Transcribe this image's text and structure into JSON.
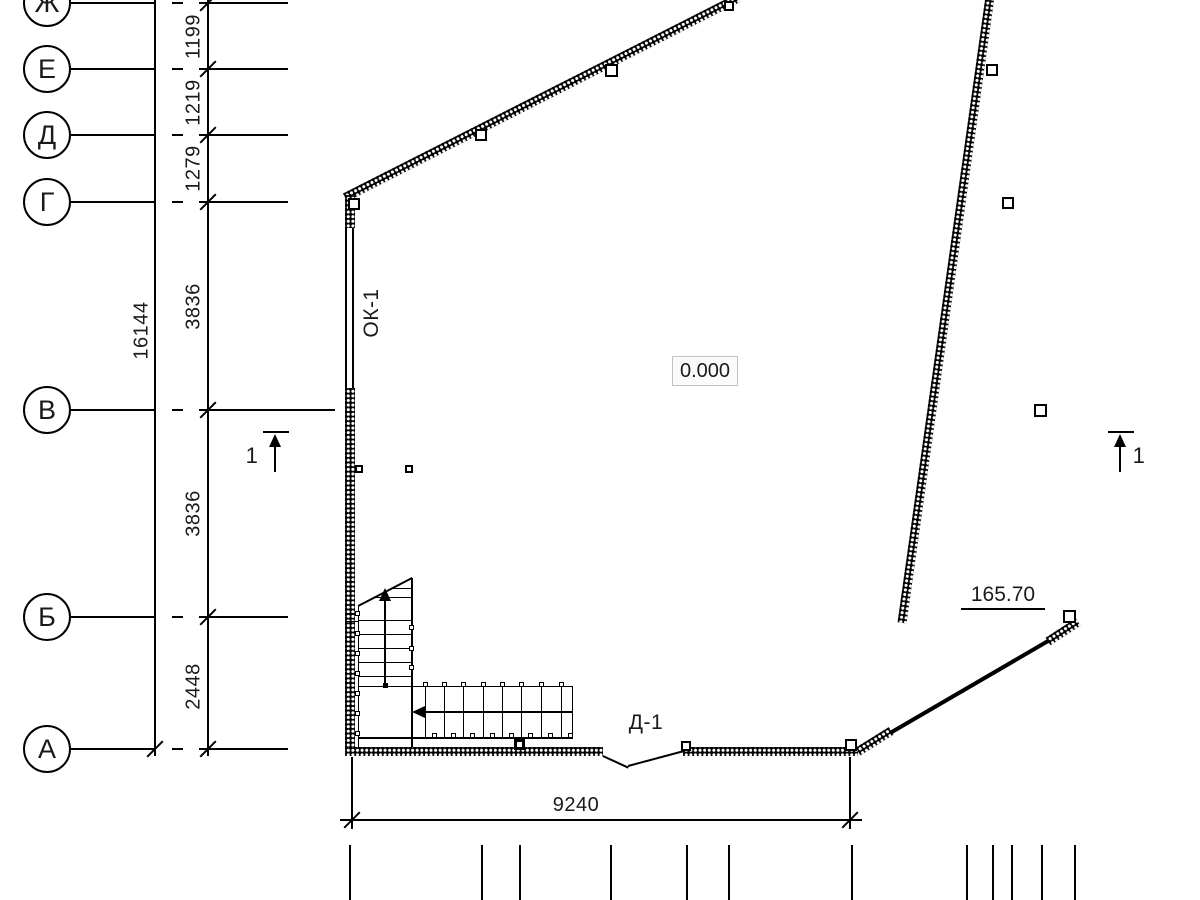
{
  "axes": {
    "rows": [
      {
        "label": "Ж",
        "y": 3
      },
      {
        "label": "Е",
        "y": 69
      },
      {
        "label": "Д",
        "y": 135
      },
      {
        "label": "Г",
        "y": 202
      },
      {
        "label": "В",
        "y": 410
      },
      {
        "label": "Б",
        "y": 617
      },
      {
        "label": "А",
        "y": 749
      }
    ]
  },
  "dimensions": {
    "left_chain": [
      {
        "value": "1199",
        "y": 36
      },
      {
        "value": "1219",
        "y": 102
      },
      {
        "value": "1279",
        "y": 168
      },
      {
        "value": "3836",
        "y": 306
      },
      {
        "value": "3836",
        "y": 513
      },
      {
        "value": "2448",
        "y": 686
      }
    ],
    "left_total": {
      "value": "16144",
      "x": 142,
      "y": 330
    },
    "bottom": {
      "value": "9240"
    }
  },
  "labels": {
    "level_zero": "0.000",
    "level_mark": "165.70",
    "window": "ОК-1",
    "door": "Д-1",
    "section_left": "1",
    "section_right": "1"
  }
}
